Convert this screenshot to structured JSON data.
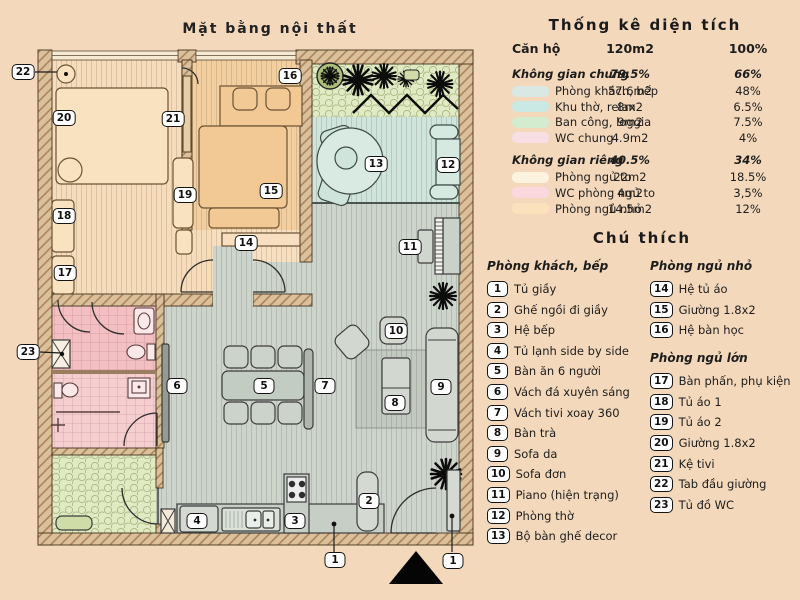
{
  "plan": {
    "title": "Mặt bằng nội thất",
    "markers": [
      {
        "n": "1",
        "x": 335,
        "y": 560
      },
      {
        "n": "1",
        "x": 453,
        "y": 561
      },
      {
        "n": "2",
        "x": 369,
        "y": 501
      },
      {
        "n": "3",
        "x": 295,
        "y": 521
      },
      {
        "n": "4",
        "x": 197,
        "y": 521
      },
      {
        "n": "5",
        "x": 264,
        "y": 386
      },
      {
        "n": "6",
        "x": 177,
        "y": 386
      },
      {
        "n": "7",
        "x": 325,
        "y": 386
      },
      {
        "n": "8",
        "x": 395,
        "y": 403
      },
      {
        "n": "9",
        "x": 441,
        "y": 387
      },
      {
        "n": "10",
        "x": 396,
        "y": 331
      },
      {
        "n": "11",
        "x": 410,
        "y": 247
      },
      {
        "n": "12",
        "x": 448,
        "y": 165
      },
      {
        "n": "13",
        "x": 376,
        "y": 164
      },
      {
        "n": "14",
        "x": 246,
        "y": 243
      },
      {
        "n": "15",
        "x": 271,
        "y": 191
      },
      {
        "n": "16",
        "x": 290,
        "y": 76
      },
      {
        "n": "17",
        "x": 65,
        "y": 273
      },
      {
        "n": "18",
        "x": 64,
        "y": 216
      },
      {
        "n": "19",
        "x": 185,
        "y": 195
      },
      {
        "n": "20",
        "x": 64,
        "y": 118
      },
      {
        "n": "21",
        "x": 173,
        "y": 119
      },
      {
        "n": "22",
        "x": 23,
        "y": 72
      },
      {
        "n": "23",
        "x": 28,
        "y": 352
      }
    ]
  },
  "stats": {
    "title": "Thống kê diện tích",
    "header": {
      "label": "Căn hộ",
      "area": "120m2",
      "percent": "100%"
    },
    "rows": [
      {
        "type": "group",
        "label": "Không gian chung",
        "area": "79.5%",
        "percent": "66%"
      },
      {
        "type": "item",
        "swatch": "#d9e8e3",
        "label": "Phòng khách, bếp",
        "area": "57.6m2",
        "percent": "48%"
      },
      {
        "type": "item",
        "swatch": "#cbe9e4",
        "label": "Khu thờ, relax",
        "area": "8m2",
        "percent": "6.5%"
      },
      {
        "type": "item",
        "swatch": "#d3ecd0",
        "label": "Ban công, loggia",
        "area": "9m2",
        "percent": "7.5%"
      },
      {
        "type": "item",
        "swatch": "#f7dfe3",
        "label": "WC chung",
        "area": "4.9m2",
        "percent": "4%"
      },
      {
        "type": "group",
        "label": "Không gian riêng",
        "area": "40.5%",
        "percent": "34%"
      },
      {
        "type": "item",
        "swatch": "#fdf3df",
        "label": "Phòng ngủ to",
        "area": "22m2",
        "percent": "18.5%"
      },
      {
        "type": "item",
        "swatch": "#fbd7de",
        "label": "WC phòng ngủ to",
        "area": "4m2",
        "percent": "3,5%"
      },
      {
        "type": "item",
        "swatch": "#fbe2bd",
        "label": "Phòng ngủ nhỏ",
        "area": "14.5m2",
        "percent": "12%"
      }
    ]
  },
  "legend": {
    "title": "Chú thích",
    "columns": [
      {
        "sections": [
          {
            "header": "Phòng khách, bếp",
            "items": [
              {
                "n": "1",
                "label": "Tủ giầy"
              },
              {
                "n": "2",
                "label": "Ghế ngồi đi giầy"
              },
              {
                "n": "3",
                "label": "Hệ bếp"
              },
              {
                "n": "4",
                "label": "Tủ lạnh side by side"
              },
              {
                "n": "5",
                "label": "Bàn ăn 6 người"
              },
              {
                "n": "6",
                "label": "Vách đá xuyên sáng"
              },
              {
                "n": "7",
                "label": "Vách tivi xoay 360"
              },
              {
                "n": "8",
                "label": "Bàn trà"
              },
              {
                "n": "9",
                "label": "Sofa da"
              },
              {
                "n": "10",
                "label": "Sofa đơn"
              },
              {
                "n": "11",
                "label": "Piano (hiện trạng)"
              },
              {
                "n": "12",
                "label": "Phòng thờ"
              },
              {
                "n": "13",
                "label": "Bộ bàn ghế decor"
              }
            ]
          }
        ]
      },
      {
        "sections": [
          {
            "header": "Phòng ngủ nhỏ",
            "items": [
              {
                "n": "14",
                "label": "Hệ tủ áo"
              },
              {
                "n": "15",
                "label": "Giường 1.8x2"
              },
              {
                "n": "16",
                "label": "Hệ bàn học"
              }
            ]
          },
          {
            "header": "Phòng ngủ lớn",
            "items": [
              {
                "n": "17",
                "label": "Bàn phấn, phụ kiện"
              },
              {
                "n": "18",
                "label": "Tủ áo 1"
              },
              {
                "n": "19",
                "label": "Tủ áo 2"
              },
              {
                "n": "20",
                "label": "Giường 1.8x2"
              },
              {
                "n": "21",
                "label": "Kệ tivi"
              },
              {
                "n": "22",
                "label": "Tab đầu giường"
              },
              {
                "n": "23",
                "label": "Tủ đồ WC"
              }
            ]
          }
        ]
      }
    ]
  }
}
